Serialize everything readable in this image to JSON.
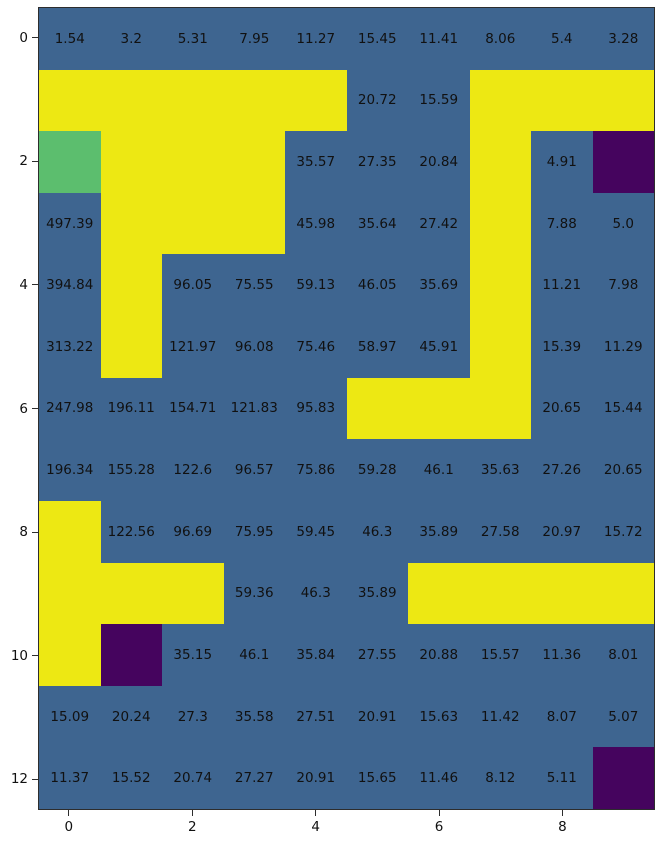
{
  "figure": {
    "background": "#ffffff",
    "spine_color": "#2d2d2d",
    "tick_color": "#2d2d2d",
    "label_color": "#111111"
  },
  "chart_data": {
    "type": "heatmap",
    "n_rows": 13,
    "n_cols": 10,
    "x_tick_labels": [
      "0",
      "2",
      "4",
      "6",
      "8"
    ],
    "x_tick_cols": [
      0,
      2,
      4,
      6,
      8
    ],
    "y_tick_labels": [
      "0",
      "2",
      "4",
      "6",
      "8",
      "10",
      "12"
    ],
    "y_tick_rows": [
      0,
      2,
      4,
      6,
      8,
      10,
      12
    ],
    "palette": {
      "blue": "#3e6590",
      "yellow": "#ede813",
      "green": "#5cbe6e",
      "purple": "#45045e"
    },
    "color_codes": {
      "b": "blue",
      "y": "yellow",
      "g": "green",
      "p": "purple"
    },
    "cell_colors": [
      "bbbbbbbbbb",
      "yyyyybbyyy",
      "gyyybbbybp",
      "byyybbbybb",
      "bybbbbbybb",
      "bybbbbbybb",
      "bbbbbyyybb",
      "bbbbbbbbbb",
      "ybbbbbbbbb",
      "yyybbbyyyy",
      "ypbbbbbbbb",
      "bbbbbbbbbb",
      "bbbbbbbbbp"
    ],
    "values": [
      [
        "1.54",
        "3.2",
        "5.31",
        "7.95",
        "11.27",
        "15.45",
        "11.41",
        "8.06",
        "5.4",
        "3.28"
      ],
      [
        "",
        "",
        "",
        "",
        "",
        "20.72",
        "15.59",
        "",
        "",
        ""
      ],
      [
        "",
        "",
        "",
        "",
        "35.57",
        "27.35",
        "20.84",
        "",
        "4.91",
        ""
      ],
      [
        "497.39",
        "",
        "",
        "",
        "45.98",
        "35.64",
        "27.42",
        "",
        "7.88",
        "5.0"
      ],
      [
        "394.84",
        "",
        "96.05",
        "75.55",
        "59.13",
        "46.05",
        "35.69",
        "",
        "11.21",
        "7.98"
      ],
      [
        "313.22",
        "",
        "121.97",
        "96.08",
        "75.46",
        "58.97",
        "45.91",
        "",
        "15.39",
        "11.29"
      ],
      [
        "247.98",
        "196.11",
        "154.71",
        "121.83",
        "95.83",
        "",
        "",
        "",
        "20.65",
        "15.44"
      ],
      [
        "196.34",
        "155.28",
        "122.6",
        "96.57",
        "75.86",
        "59.28",
        "46.1",
        "35.63",
        "27.26",
        "20.65"
      ],
      [
        "",
        "122.56",
        "96.69",
        "75.95",
        "59.45",
        "46.3",
        "35.89",
        "27.58",
        "20.97",
        "15.72"
      ],
      [
        "",
        "",
        "",
        "59.36",
        "46.3",
        "35.89",
        "",
        "",
        "",
        ""
      ],
      [
        "",
        "",
        "35.15",
        "46.1",
        "35.84",
        "27.55",
        "20.88",
        "15.57",
        "11.36",
        "8.01"
      ],
      [
        "15.09",
        "20.24",
        "27.3",
        "35.58",
        "27.51",
        "20.91",
        "15.63",
        "11.42",
        "8.07",
        "5.07"
      ],
      [
        "11.37",
        "15.52",
        "20.74",
        "27.27",
        "20.91",
        "15.65",
        "11.46",
        "8.12",
        "5.11",
        ""
      ]
    ]
  }
}
